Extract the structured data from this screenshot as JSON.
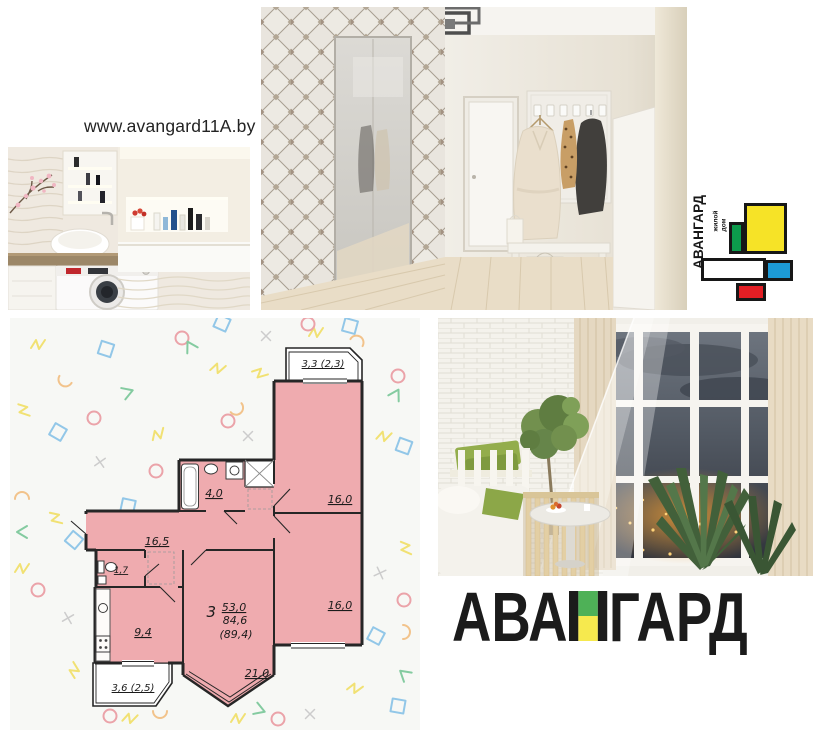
{
  "header": {
    "website_url": "www.avangard11A.by"
  },
  "logo": {
    "brand": "АВАНГАРД",
    "tagline_word1": "жилой",
    "tagline_word2": "дом",
    "colors": {
      "yellow": "#f6e327",
      "green": "#0c9b4c",
      "blue": "#1c9ad6",
      "red": "#e31e24",
      "outline": "#171717"
    }
  },
  "brand_title": {
    "part1": "АВА",
    "letter_n": "Н",
    "part2": "ГАРД",
    "letter_colors": {
      "top": "#4eb157",
      "bottom": "#f6e94e"
    }
  },
  "floor_plan": {
    "rooms_count": "3",
    "living_area": "53,0",
    "total_area": "84,6",
    "area_with_balconies": "(89,4)",
    "labels": {
      "balcony_top": "3,3 (2,3)",
      "bedroom_1": "16,0",
      "bedroom_2": "16,0",
      "bathroom": "4,0",
      "hallway": "16,5",
      "wc": "1,7",
      "kitchen": "9,4",
      "balcony_bottom": "3,6 (2,5)",
      "living_room": "21,0"
    },
    "colors": {
      "room_fill": "#efabaf",
      "walls": "#262626",
      "card_bg": "#f7f8f5"
    }
  }
}
